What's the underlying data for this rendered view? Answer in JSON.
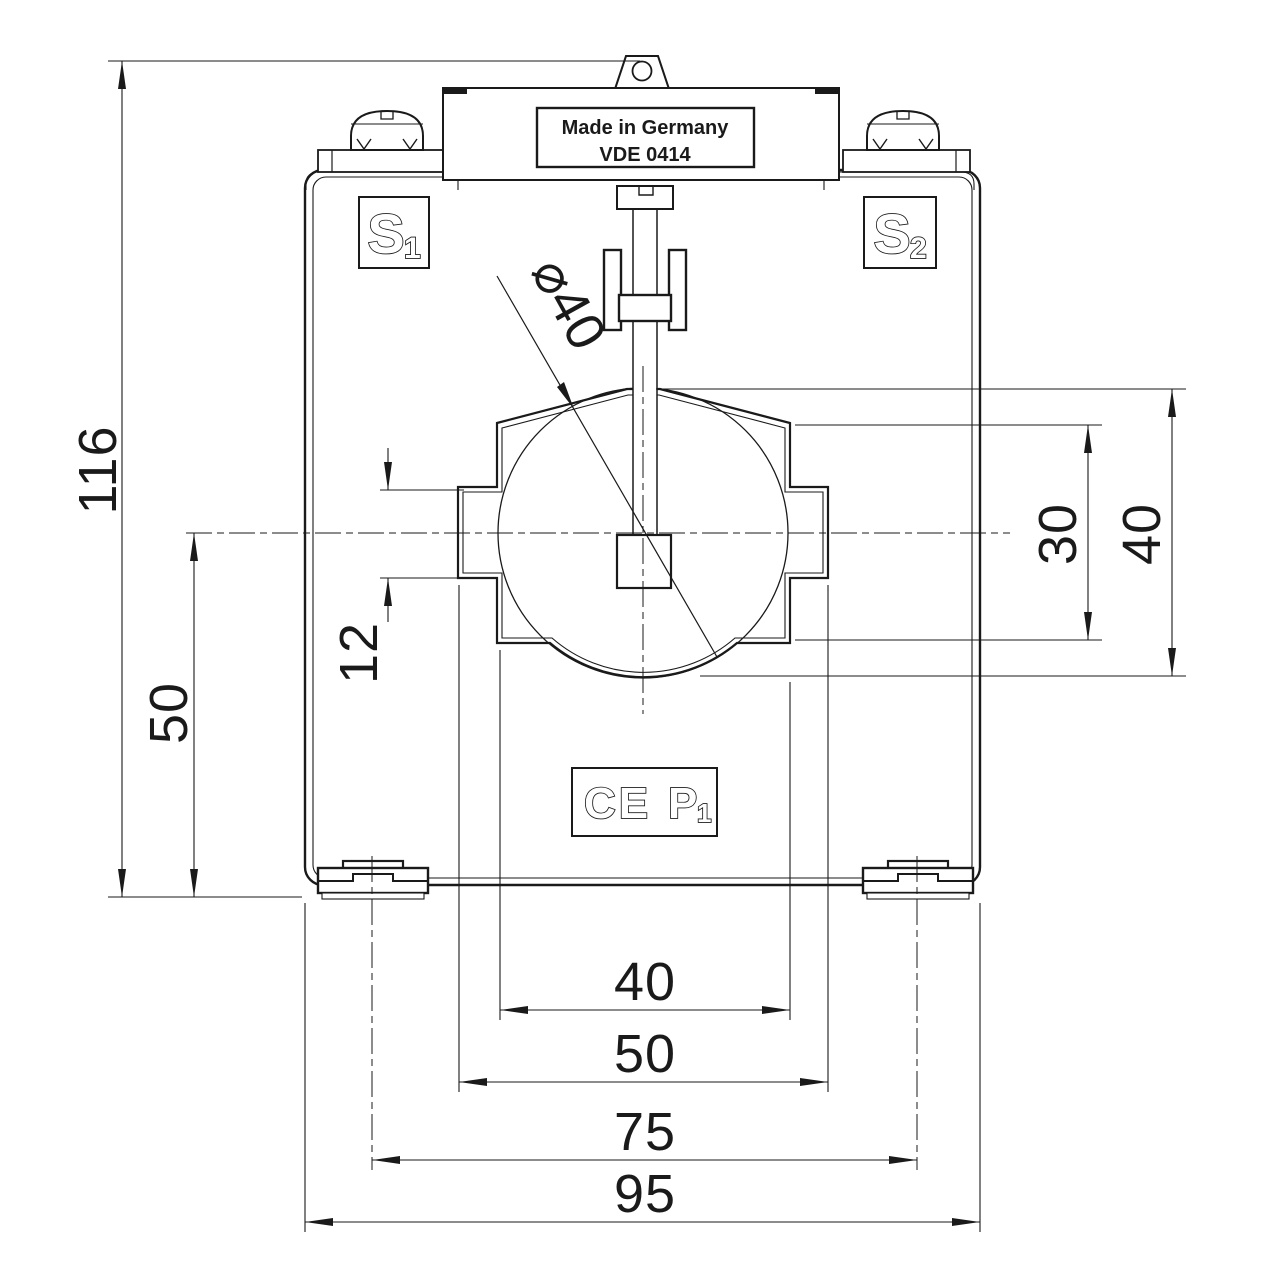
{
  "drawing": {
    "product_labels": {
      "made_in": "Made in Germany",
      "standard": "VDE 0414",
      "terminal_s1": {
        "main": "S",
        "sub": "1"
      },
      "terminal_s2": {
        "main": "S",
        "sub": "2"
      },
      "ce_mark": "CE",
      "p1": {
        "main": "P",
        "sub": "1"
      }
    },
    "dimensions": {
      "total_height": "116",
      "center_to_bottom": "50",
      "side_slot_height": "12",
      "window_diameter": "⌀40",
      "window_mid_height": "30",
      "window_height": "40",
      "window_mid_width": "40",
      "window_width": "50",
      "feet_spacing": "75",
      "total_width": "95"
    },
    "colors": {
      "line": "#1a1a1a",
      "background": "#ffffff"
    }
  }
}
